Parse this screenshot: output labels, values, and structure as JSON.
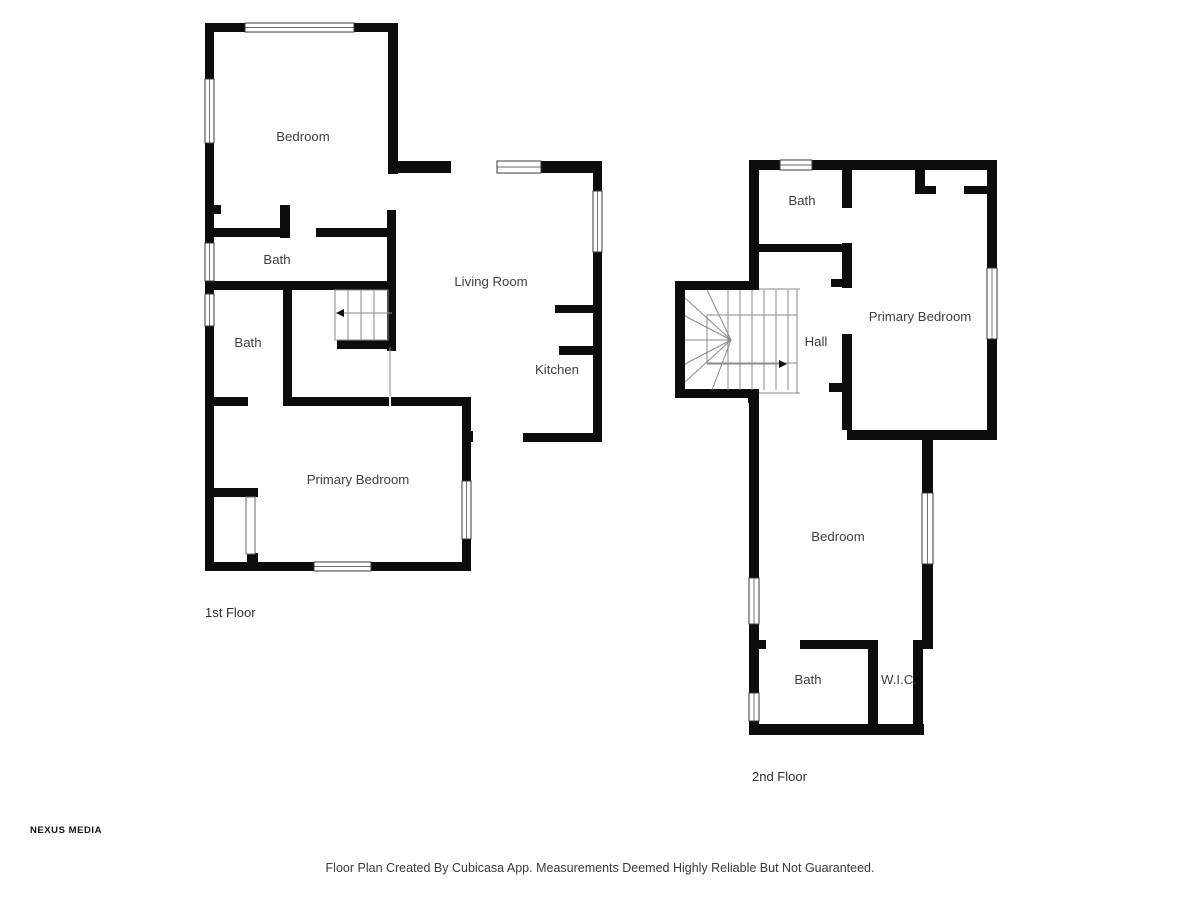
{
  "meta": {
    "footer": "Floor Plan Created By Cubicasa App. Measurements Deemed Highly Reliable But Not Guaranteed.",
    "brand": "NEXUS MEDIA",
    "colors": {
      "wall": "#0d0d0d",
      "label": "#3f3f3f",
      "window": "#3a3a3a",
      "stair": "#8a8a8a",
      "door": "#6a6a6a",
      "overlay": "#f2f2f2"
    }
  },
  "floors": [
    {
      "name": "1st Floor",
      "rooms": [
        {
          "label": "Bedroom",
          "x": 303,
          "y": 141
        },
        {
          "label": "Bath",
          "x": 277,
          "y": 264
        },
        {
          "label": "Bath",
          "x": 248,
          "y": 347
        },
        {
          "label": "Living Room",
          "x": 491,
          "y": 286
        },
        {
          "label": "Kitchen",
          "x": 557,
          "y": 374
        },
        {
          "label": "Primary Bedroom",
          "x": 358,
          "y": 484
        }
      ],
      "walls": [
        [
          205,
          23,
          40,
          9
        ],
        [
          354,
          23,
          44,
          9
        ],
        [
          205,
          23,
          9,
          56
        ],
        [
          205,
          143,
          9,
          100
        ],
        [
          205,
          281,
          9,
          13
        ],
        [
          205,
          326,
          9,
          237
        ],
        [
          205,
          562,
          109,
          9
        ],
        [
          371,
          562,
          100,
          9
        ],
        [
          462,
          397,
          9,
          84
        ],
        [
          462,
          539,
          9,
          32
        ],
        [
          283,
          397,
          188,
          9
        ],
        [
          205,
          397,
          43,
          9
        ],
        [
          388,
          23,
          10,
          151
        ],
        [
          397,
          161,
          54,
          12
        ],
        [
          541,
          161,
          61,
          12
        ],
        [
          593,
          173,
          9,
          18
        ],
        [
          593,
          252,
          9,
          190
        ],
        [
          523,
          433,
          79,
          9
        ],
        [
          555,
          305,
          47,
          8
        ],
        [
          559,
          346,
          43,
          9
        ],
        [
          387,
          210,
          9,
          73
        ],
        [
          205,
          228,
          79,
          9
        ],
        [
          316,
          228,
          72,
          9
        ],
        [
          280,
          205,
          10,
          33
        ],
        [
          205,
          205,
          16,
          9
        ],
        [
          205,
          281,
          191,
          9
        ],
        [
          283,
          281,
          9,
          125
        ],
        [
          387,
          281,
          9,
          70
        ],
        [
          337,
          340,
          59,
          9
        ],
        [
          205,
          488,
          53,
          9
        ],
        [
          247,
          553,
          11,
          10
        ],
        [
          464,
          431,
          9,
          11
        ]
      ],
      "windows": [
        [
          245,
          23,
          109,
          9
        ],
        [
          205,
          79,
          9,
          64
        ],
        [
          205,
          243,
          9,
          38
        ],
        [
          205,
          294,
          9,
          32
        ],
        [
          314,
          562,
          57,
          9
        ],
        [
          462,
          481,
          9,
          58
        ],
        [
          497,
          161,
          44,
          12
        ],
        [
          593,
          191,
          9,
          61
        ]
      ],
      "door_panels": [
        [
          246,
          497,
          9,
          57
        ]
      ],
      "outlines": [
        [
          335,
          290,
          53,
          50
        ]
      ],
      "lines": [
        [
          348,
          290,
          348,
          340
        ],
        [
          361,
          290,
          361,
          340
        ],
        [
          374,
          290,
          374,
          340
        ],
        [
          343,
          313,
          392,
          313
        ],
        [
          390,
          347,
          390,
          397
        ]
      ],
      "overlays": [
        [
          390,
          396,
          390,
          407
        ]
      ],
      "arrows": [
        [
          [
            336,
            313
          ],
          [
            344,
            309
          ],
          [
            344,
            317
          ]
        ]
      ]
    },
    {
      "name": "2nd Floor",
      "rooms": [
        {
          "label": "Bath",
          "x": 802,
          "y": 205
        },
        {
          "label": "Primary Bedroom",
          "x": 920,
          "y": 321
        },
        {
          "label": "Hall",
          "x": 816,
          "y": 346
        },
        {
          "label": "Bedroom",
          "x": 838,
          "y": 541
        },
        {
          "label": "Bath",
          "x": 808,
          "y": 684
        },
        {
          "label": "W.I.C.",
          "x": 899,
          "y": 684
        }
      ],
      "walls": [
        [
          749,
          160,
          31,
          10
        ],
        [
          812,
          160,
          185,
          10
        ],
        [
          749,
          160,
          10,
          130
        ],
        [
          675,
          281,
          84,
          9
        ],
        [
          675,
          281,
          10,
          117
        ],
        [
          675,
          389,
          84,
          9
        ],
        [
          748,
          389,
          11,
          14
        ],
        [
          749,
          398,
          10,
          180
        ],
        [
          749,
          624,
          10,
          69
        ],
        [
          749,
          721,
          10,
          14
        ],
        [
          749,
          724,
          175,
          11
        ],
        [
          868,
          640,
          10,
          85
        ],
        [
          749,
          640,
          17,
          9
        ],
        [
          800,
          640,
          78,
          9
        ],
        [
          913,
          640,
          11,
          9
        ],
        [
          913,
          648,
          10,
          78
        ],
        [
          922,
          440,
          11,
          53
        ],
        [
          922,
          564,
          11,
          85
        ],
        [
          847,
          430,
          148,
          10
        ],
        [
          842,
          170,
          10,
          38
        ],
        [
          757,
          244,
          88,
          8
        ],
        [
          842,
          243,
          10,
          45
        ],
        [
          831,
          279,
          11,
          8
        ],
        [
          842,
          334,
          10,
          96
        ],
        [
          829,
          383,
          13,
          9
        ],
        [
          915,
          170,
          10,
          24
        ],
        [
          915,
          186,
          21,
          8
        ],
        [
          964,
          186,
          23,
          8
        ],
        [
          987,
          160,
          10,
          108
        ],
        [
          987,
          339,
          10,
          101
        ]
      ],
      "windows": [
        [
          780,
          160,
          32,
          10
        ],
        [
          987,
          268,
          10,
          71
        ],
        [
          922,
          493,
          11,
          71
        ],
        [
          749,
          578,
          10,
          46
        ],
        [
          749,
          693,
          10,
          28
        ]
      ],
      "door_panels": [],
      "outlines": [
        [
          707,
          315,
          90,
          48
        ]
      ],
      "lines": [
        [
          797,
          289,
          797,
          393
        ],
        [
          759,
          289,
          800,
          289
        ],
        [
          759,
          393,
          800,
          393
        ],
        [
          728,
          290,
          728,
          390
        ],
        [
          740,
          290,
          740,
          390
        ],
        [
          752,
          290,
          752,
          390
        ],
        [
          764,
          290,
          764,
          390
        ],
        [
          776,
          290,
          776,
          390
        ],
        [
          788,
          290,
          788,
          390
        ],
        [
          731,
          340,
          707,
          290
        ],
        [
          731,
          340,
          685,
          298
        ],
        [
          731,
          340,
          685,
          316
        ],
        [
          731,
          340,
          685,
          340
        ],
        [
          731,
          340,
          685,
          364
        ],
        [
          731,
          340,
          685,
          382
        ],
        [
          731,
          340,
          712,
          390
        ],
        [
          707,
          364,
          779,
          364
        ]
      ],
      "overlays": [],
      "arrows": [
        [
          [
            787,
            364
          ],
          [
            779,
            360
          ],
          [
            779,
            368
          ]
        ]
      ]
    }
  ]
}
